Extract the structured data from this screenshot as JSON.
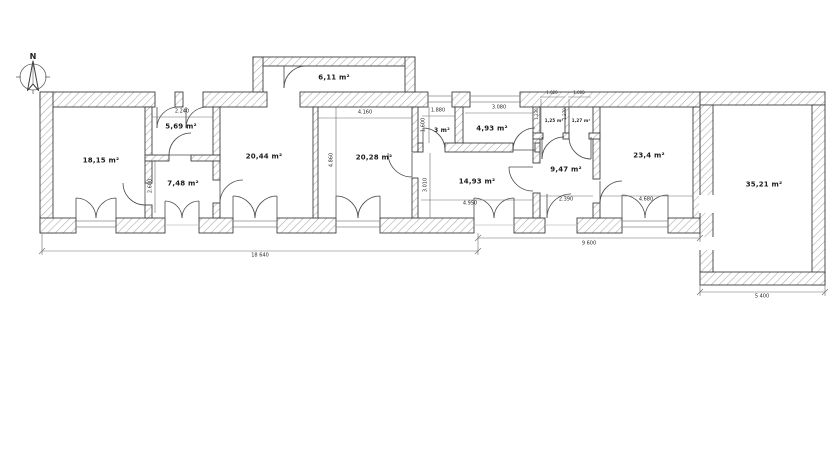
{
  "compass": {
    "label": "N"
  },
  "rooms": [
    {
      "id": "room-18-15",
      "label": "18,15 m²"
    },
    {
      "id": "room-5-69",
      "label": "5,69 m²"
    },
    {
      "id": "room-7-48",
      "label": "7,48 m²"
    },
    {
      "id": "room-20-44",
      "label": "20,44 m²"
    },
    {
      "id": "room-20-28",
      "label": "20,28 m²"
    },
    {
      "id": "room-3",
      "label": "3 m²"
    },
    {
      "id": "room-4-93",
      "label": "4,93 m²"
    },
    {
      "id": "room-14-93",
      "label": "14,93 m²"
    },
    {
      "id": "room-1-25",
      "label": "1,25 m²"
    },
    {
      "id": "room-1-27",
      "label": "1,27 m²"
    },
    {
      "id": "room-9-47",
      "label": "9,47 m²"
    },
    {
      "id": "room-23-4",
      "label": "23,4 m²"
    },
    {
      "id": "room-35-21",
      "label": "35,21 m²"
    },
    {
      "id": "room-6-11",
      "label": "6,11 m²"
    }
  ],
  "dimensions": [
    {
      "id": "dim-2240",
      "label": "2.240"
    },
    {
      "id": "dim-4160",
      "label": "4.160"
    },
    {
      "id": "dim-1880",
      "label": "1.880"
    },
    {
      "id": "dim-3080",
      "label": "3.080"
    },
    {
      "id": "dim-1020",
      "label": "1.020"
    },
    {
      "id": "dim-1000",
      "label": "1.000"
    },
    {
      "id": "dim-4950",
      "label": "4.950"
    },
    {
      "id": "dim-2390",
      "label": "2.390"
    },
    {
      "id": "dim-4680",
      "label": "4.680"
    },
    {
      "id": "dim-2600",
      "label": "2.600"
    },
    {
      "id": "dim-4860",
      "label": "4.860"
    },
    {
      "id": "dim-1600",
      "label": "1.600"
    },
    {
      "id": "dim-3010",
      "label": "3.010"
    },
    {
      "id": "dim-1230",
      "label": "1.230"
    },
    {
      "id": "dim-1270",
      "label": "1.270"
    },
    {
      "id": "dim-18640",
      "label": "18 640"
    },
    {
      "id": "dim-9600",
      "label": "9 600"
    },
    {
      "id": "dim-5400",
      "label": "5 400"
    }
  ]
}
